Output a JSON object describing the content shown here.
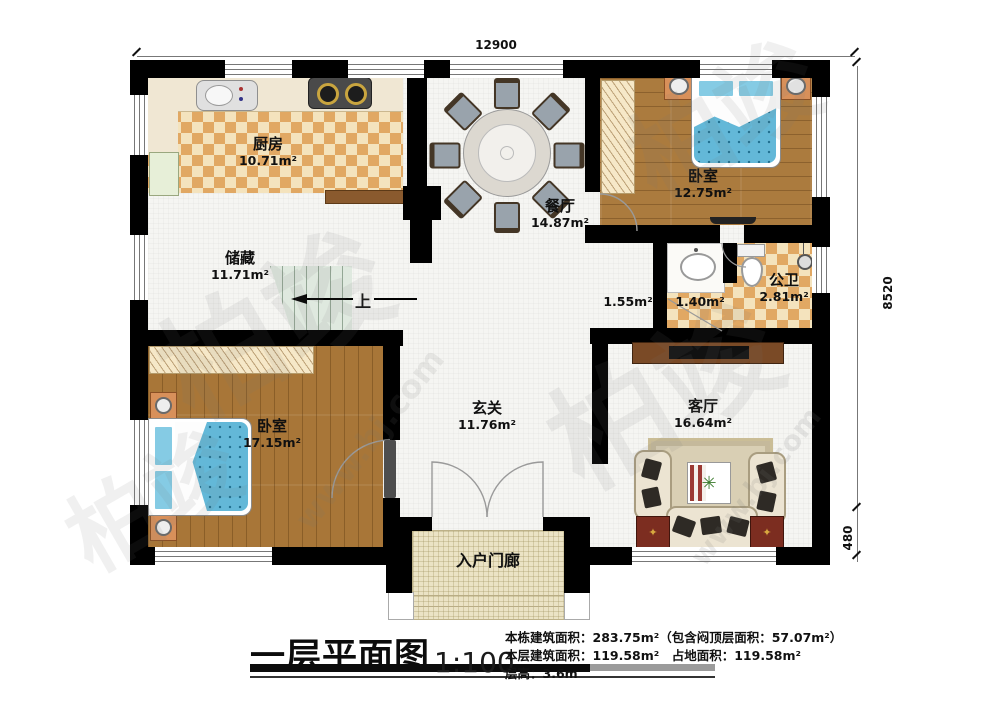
{
  "plan": {
    "dimensions": {
      "width_top": "12900",
      "height_right": "8520",
      "offset_bottom_right": "480"
    },
    "rooms": {
      "kitchen": {
        "name": "厨房",
        "area": "10.71m²"
      },
      "dining": {
        "name": "餐厅",
        "area": "14.87m²"
      },
      "bedroom_top": {
        "name": "卧室",
        "area": "12.75m²"
      },
      "storage": {
        "name": "储藏",
        "area": "11.71m²"
      },
      "hall_small": {
        "area": "1.55m²"
      },
      "washroom": {
        "area": "1.40m²"
      },
      "bathroom": {
        "name": "公卫",
        "area": "2.81m²"
      },
      "bedroom_bottom": {
        "name": "卧室",
        "area": "17.15m²"
      },
      "foyer": {
        "name": "玄关",
        "area": "11.76m²"
      },
      "living": {
        "name": "客厅",
        "area": "16.64m²"
      },
      "porch": {
        "name": "入户门廊"
      }
    },
    "stairs": {
      "up_label": "上"
    }
  },
  "title_block": {
    "title": "一层平面图",
    "scale": "1:100",
    "info_line1": "本栋建筑面积：283.75m²（包含闷顶层面积：57.07m²）",
    "info_line2": "本层建筑面积：119.58m²　占地面积：119.58m²",
    "info_line3": "层高：3.6m"
  },
  "watermark": {
    "logo": "柏竣",
    "url": "www.bj.com"
  },
  "colors": {
    "wall": "#000000",
    "wood": "#a87638",
    "tile_dark": "#e1a863",
    "bed_blue": "#63b8d8"
  }
}
